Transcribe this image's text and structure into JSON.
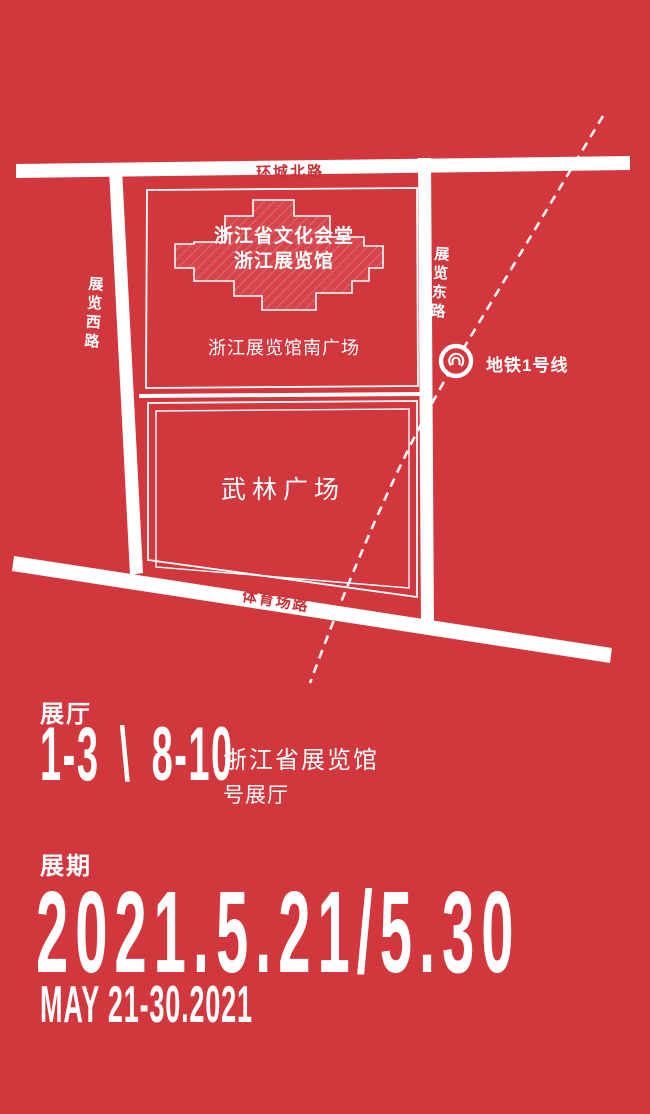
{
  "colors": {
    "background": "#d2373e",
    "foreground": "#ffffff",
    "road_label": "#c93138"
  },
  "map": {
    "roads": {
      "north": "环城北路",
      "west": "展览西路",
      "east": "展览东路",
      "south": "体育场路"
    },
    "building": {
      "line1": "浙江省文化会堂",
      "line2": "浙江展览馆"
    },
    "south_square_label": "浙江展览馆南广场",
    "wulin_square_label": "武林广场",
    "metro_line_label": "地铁1号线"
  },
  "halls": {
    "heading": "展厅",
    "range1": "1-3",
    "separator": "\\",
    "range2": "8-10",
    "venue_line1": "浙江省展览馆",
    "venue_line2": "号展厅"
  },
  "period": {
    "heading": "展期",
    "dates": "2021.5.21/5.30",
    "dates_en": "MAY 21-30.2021"
  }
}
